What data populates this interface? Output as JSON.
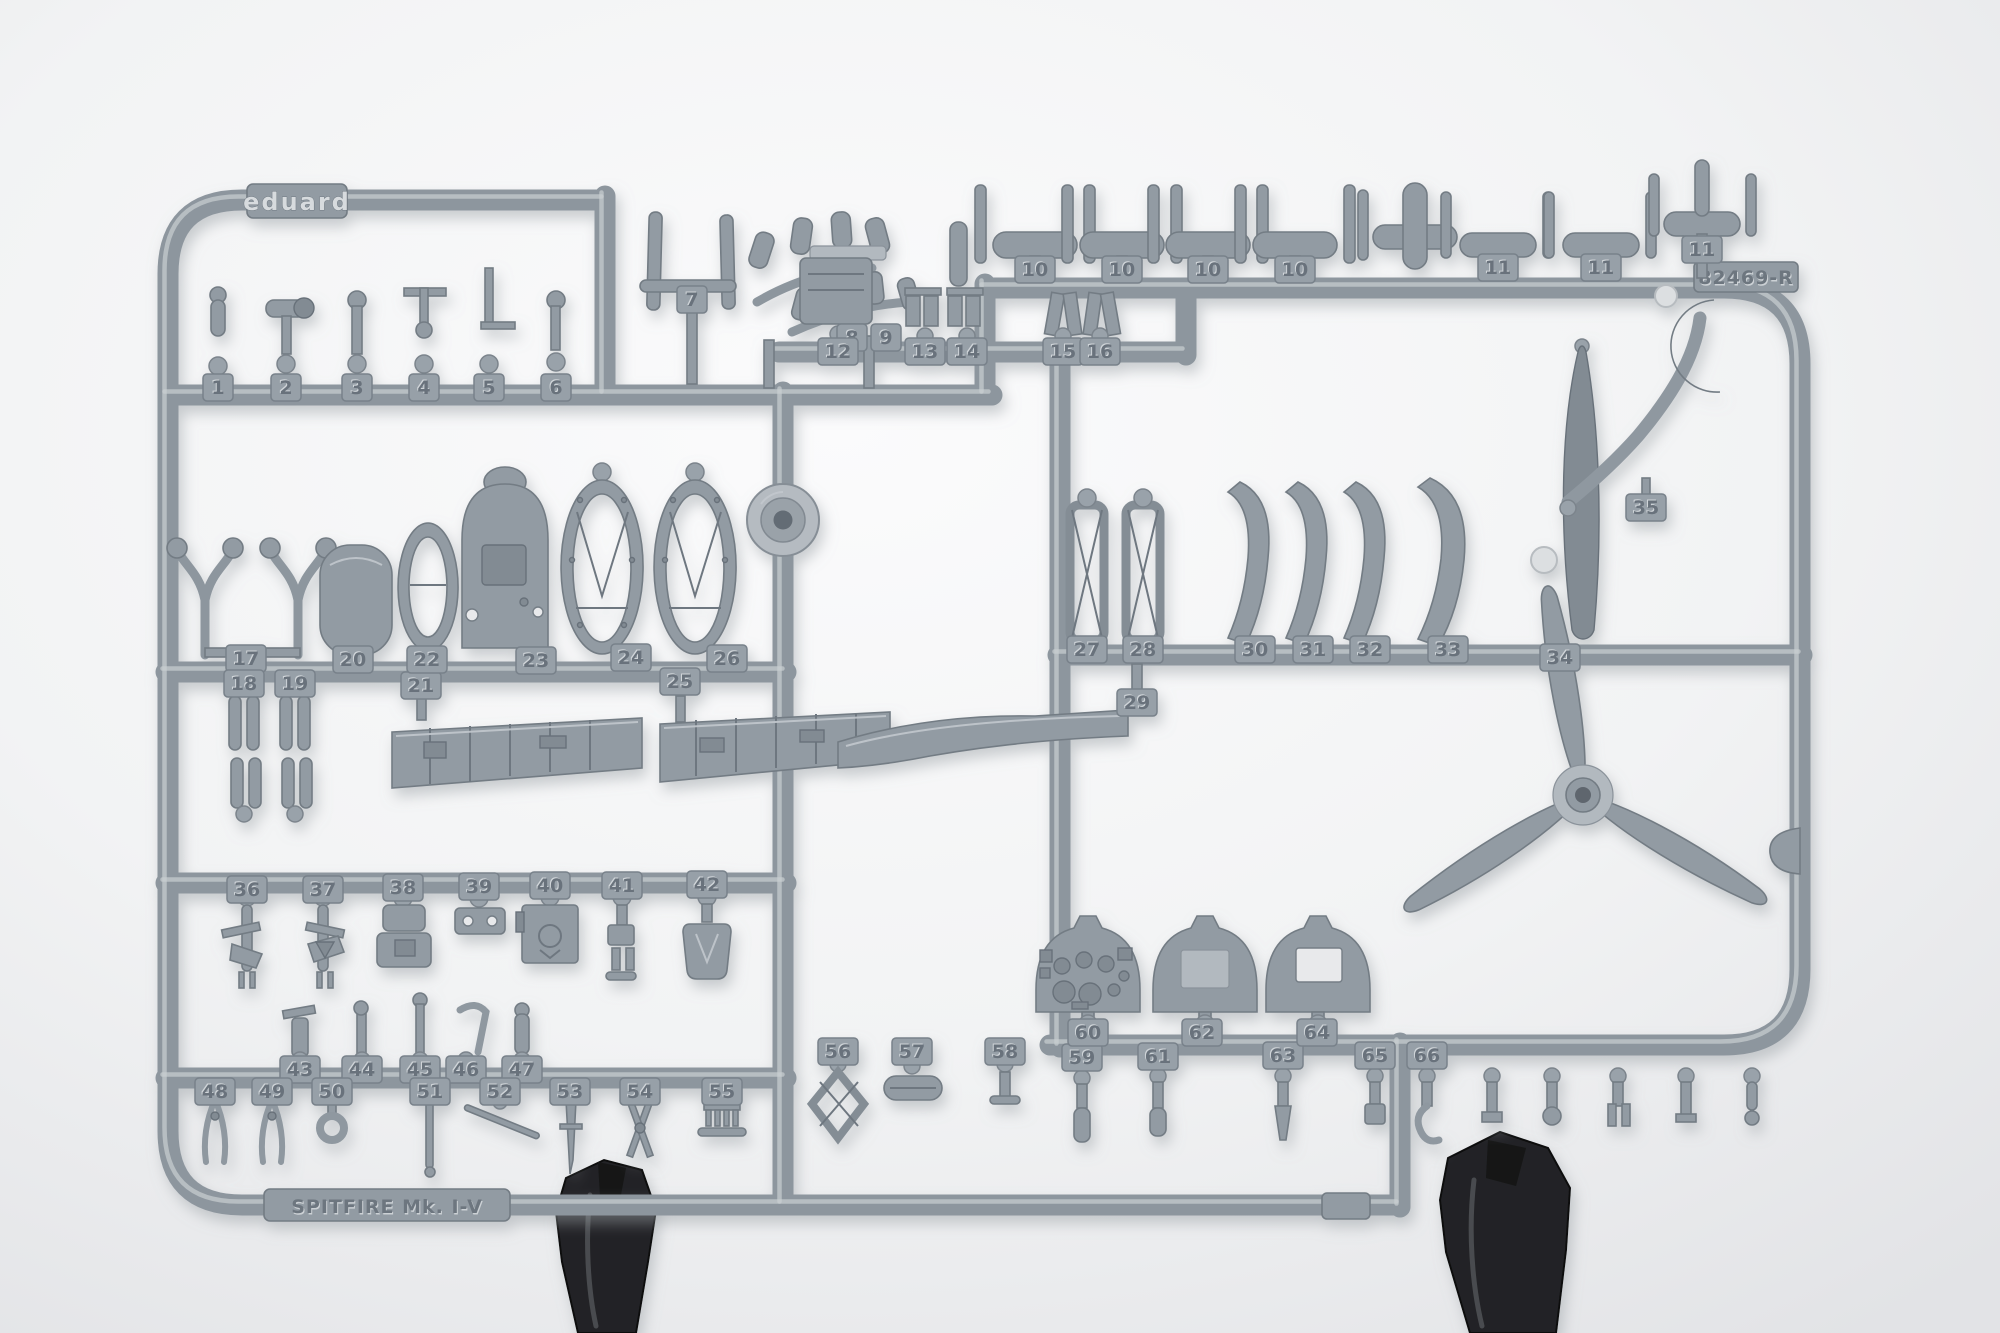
{
  "photo": {
    "markings": {
      "brand_logo": "eduard",
      "sprue_code": "82469-R",
      "kit_name_plate": "SPITFIRE Mk. I-V"
    },
    "colors": {
      "background": "#f4f5f6",
      "sprue_plastic": "#8d969e",
      "sprue_highlight": "#c9ced2",
      "sprue_shadow": "#737c84",
      "tag_plate": "#97a0a8",
      "number_emboss": "#69727b",
      "clamp_black": "#222325"
    },
    "part_tags": [
      {
        "label": "1",
        "x": 218,
        "y": 388
      },
      {
        "label": "2",
        "x": 286,
        "y": 388
      },
      {
        "label": "3",
        "x": 357,
        "y": 388
      },
      {
        "label": "4",
        "x": 424,
        "y": 388
      },
      {
        "label": "5",
        "x": 489,
        "y": 388
      },
      {
        "label": "6",
        "x": 556,
        "y": 388
      },
      {
        "label": "7",
        "x": 692,
        "y": 300
      },
      {
        "label": "8",
        "x": 852,
        "y": 338
      },
      {
        "label": "9",
        "x": 886,
        "y": 338
      },
      {
        "label": "10",
        "x": 1035,
        "y": 270
      },
      {
        "label": "10",
        "x": 1122,
        "y": 270
      },
      {
        "label": "10",
        "x": 1208,
        "y": 270
      },
      {
        "label": "10",
        "x": 1295,
        "y": 270
      },
      {
        "label": "11",
        "x": 1498,
        "y": 268
      },
      {
        "label": "11",
        "x": 1601,
        "y": 268
      },
      {
        "label": "11",
        "x": 1702,
        "y": 250
      },
      {
        "label": "12",
        "x": 838,
        "y": 352
      },
      {
        "label": "13",
        "x": 925,
        "y": 352
      },
      {
        "label": "14",
        "x": 967,
        "y": 352
      },
      {
        "label": "15",
        "x": 1063,
        "y": 352
      },
      {
        "label": "16",
        "x": 1100,
        "y": 352
      },
      {
        "label": "17",
        "x": 246,
        "y": 659
      },
      {
        "label": "18",
        "x": 244,
        "y": 684
      },
      {
        "label": "19",
        "x": 295,
        "y": 684
      },
      {
        "label": "20",
        "x": 353,
        "y": 660
      },
      {
        "label": "21",
        "x": 421,
        "y": 686
      },
      {
        "label": "22",
        "x": 427,
        "y": 660
      },
      {
        "label": "23",
        "x": 536,
        "y": 661
      },
      {
        "label": "24",
        "x": 631,
        "y": 658
      },
      {
        "label": "25",
        "x": 680,
        "y": 682
      },
      {
        "label": "26",
        "x": 727,
        "y": 659
      },
      {
        "label": "27",
        "x": 1087,
        "y": 650
      },
      {
        "label": "28",
        "x": 1143,
        "y": 650
      },
      {
        "label": "29",
        "x": 1137,
        "y": 703
      },
      {
        "label": "30",
        "x": 1255,
        "y": 650
      },
      {
        "label": "31",
        "x": 1313,
        "y": 650
      },
      {
        "label": "32",
        "x": 1370,
        "y": 650
      },
      {
        "label": "33",
        "x": 1448,
        "y": 650
      },
      {
        "label": "34",
        "x": 1560,
        "y": 658
      },
      {
        "label": "35",
        "x": 1646,
        "y": 508
      },
      {
        "label": "36",
        "x": 247,
        "y": 890
      },
      {
        "label": "37",
        "x": 323,
        "y": 890
      },
      {
        "label": "38",
        "x": 403,
        "y": 888
      },
      {
        "label": "39",
        "x": 479,
        "y": 887
      },
      {
        "label": "40",
        "x": 550,
        "y": 886
      },
      {
        "label": "41",
        "x": 622,
        "y": 886
      },
      {
        "label": "42",
        "x": 707,
        "y": 885
      },
      {
        "label": "43",
        "x": 300,
        "y": 1070
      },
      {
        "label": "44",
        "x": 362,
        "y": 1070
      },
      {
        "label": "45",
        "x": 420,
        "y": 1070
      },
      {
        "label": "46",
        "x": 466,
        "y": 1070
      },
      {
        "label": "47",
        "x": 522,
        "y": 1070
      },
      {
        "label": "48",
        "x": 215,
        "y": 1092
      },
      {
        "label": "49",
        "x": 272,
        "y": 1092
      },
      {
        "label": "50",
        "x": 332,
        "y": 1092
      },
      {
        "label": "51",
        "x": 430,
        "y": 1092
      },
      {
        "label": "52",
        "x": 500,
        "y": 1092
      },
      {
        "label": "53",
        "x": 570,
        "y": 1092
      },
      {
        "label": "54",
        "x": 640,
        "y": 1092
      },
      {
        "label": "55",
        "x": 722,
        "y": 1092
      },
      {
        "label": "56",
        "x": 838,
        "y": 1052
      },
      {
        "label": "57",
        "x": 912,
        "y": 1052
      },
      {
        "label": "58",
        "x": 1005,
        "y": 1052
      },
      {
        "label": "59",
        "x": 1082,
        "y": 1058
      },
      {
        "label": "60",
        "x": 1088,
        "y": 1033
      },
      {
        "label": "61",
        "x": 1158,
        "y": 1057
      },
      {
        "label": "62",
        "x": 1202,
        "y": 1033
      },
      {
        "label": "63",
        "x": 1283,
        "y": 1056
      },
      {
        "label": "64",
        "x": 1317,
        "y": 1033
      },
      {
        "label": "65",
        "x": 1375,
        "y": 1056
      },
      {
        "label": "66",
        "x": 1427,
        "y": 1056
      }
    ]
  }
}
